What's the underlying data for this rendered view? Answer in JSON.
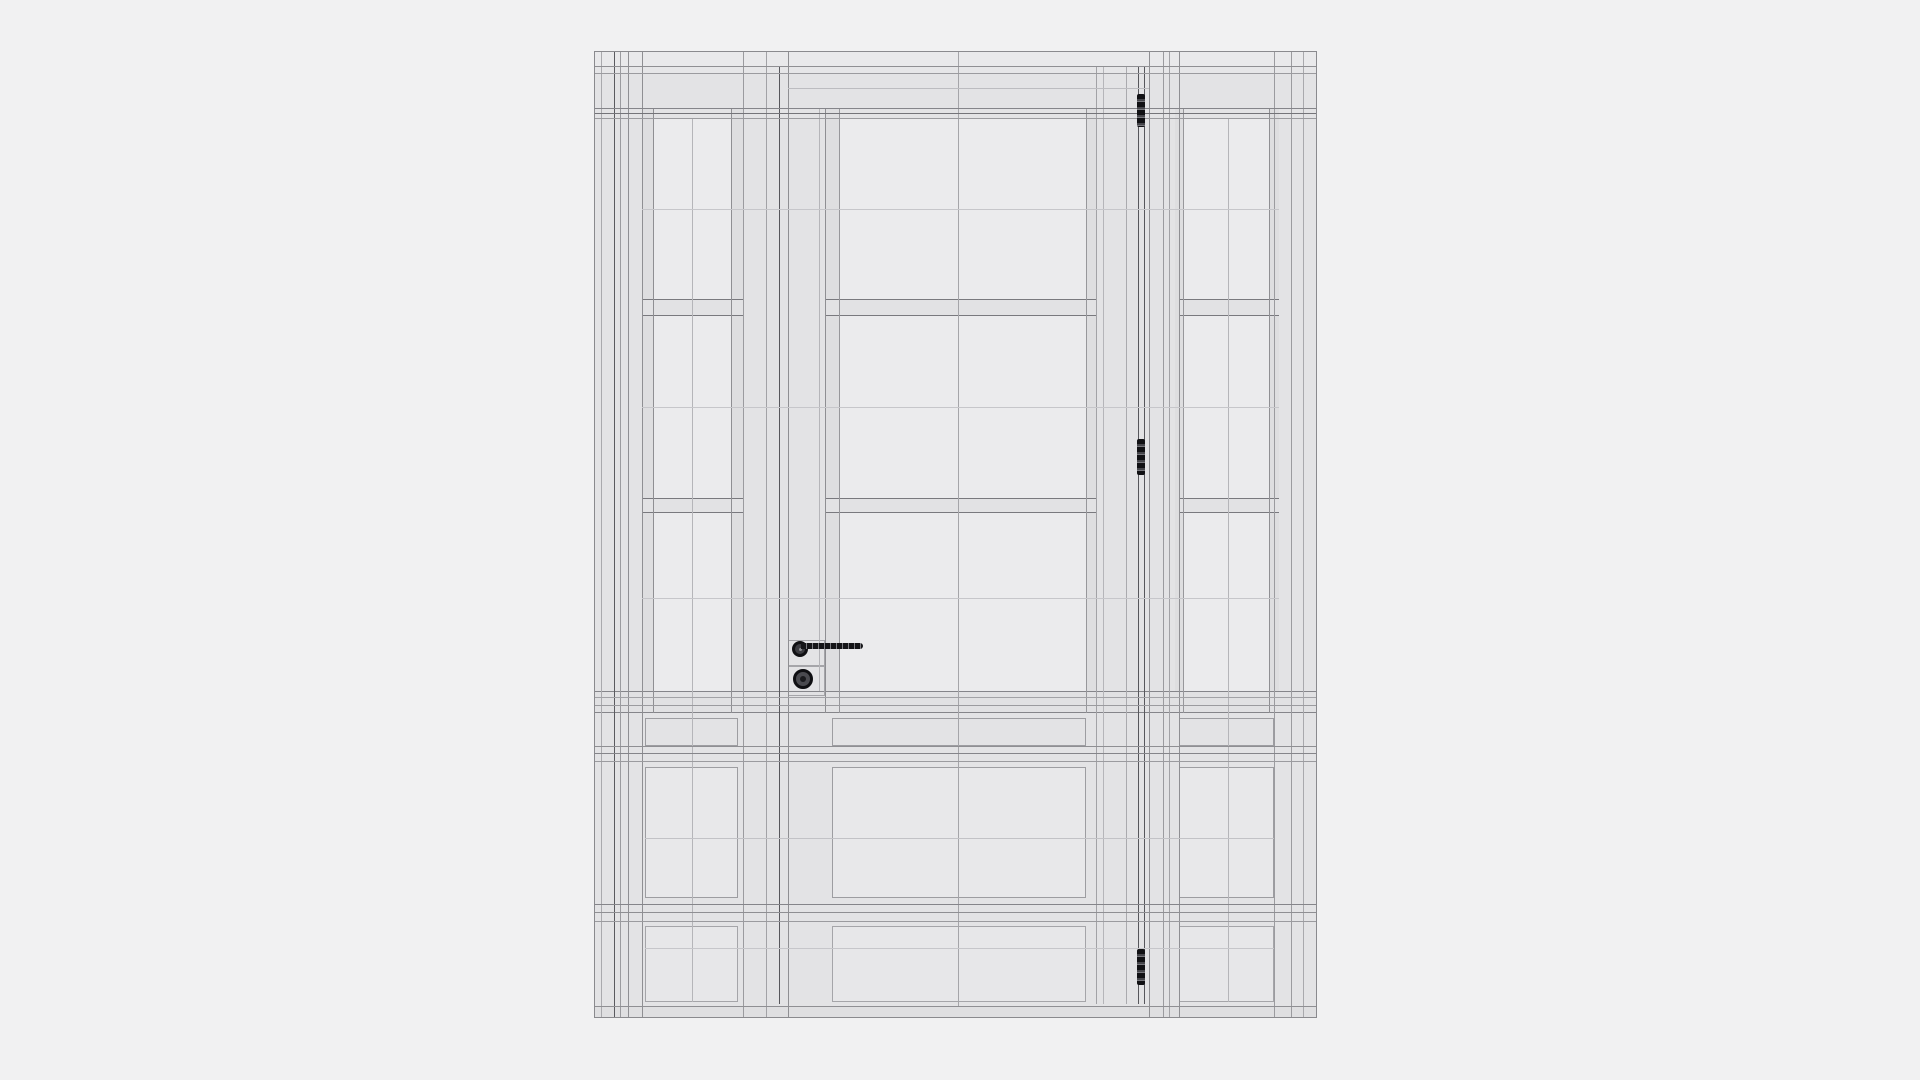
{
  "meta": {
    "description": "monochrome wireframe render of an entry door with two sidelights, three hinges, lever handle and cylinder knob",
    "background_color": "#f1f1f2",
    "unit_fill": "#e3e3e5",
    "glass_fill": "#ebebed",
    "line_dark": "#57575c",
    "line_mid": "#8f8f93",
    "line_light": "#c6c6ca",
    "hardware_color": "#151518"
  },
  "scene": {
    "unit": {
      "x": 594,
      "y": 51,
      "w": 723,
      "h": 967,
      "fill": "#e3e3e5"
    },
    "rects": [
      {
        "name": "frame-head-band",
        "x": 0,
        "y": 0,
        "w": 723,
        "h": 14,
        "fill": "#e9e9eb"
      },
      {
        "name": "frame-head-lower",
        "x": 0,
        "y": 14,
        "w": 723,
        "h": 7,
        "fill": "#e6e6e8"
      },
      {
        "name": "sidelight-left-glass",
        "x": 58,
        "y": 66,
        "w": 78,
        "h": 573,
        "fill": "#ebebed"
      },
      {
        "name": "door-glass",
        "x": 244,
        "y": 66,
        "w": 247,
        "h": 573,
        "fill": "#ebebed"
      },
      {
        "name": "sidelight-right-glass",
        "x": 588,
        "y": 66,
        "w": 86,
        "h": 573,
        "fill": "#ebebed"
      },
      {
        "name": "glass-frame-strip",
        "x": 47,
        "y": 56,
        "w": 11,
        "h": 605,
        "fill": "#dedee0"
      },
      {
        "name": "glass-frame-strip",
        "x": 136,
        "y": 56,
        "w": 12,
        "h": 605,
        "fill": "#dedee0"
      },
      {
        "name": "glass-frame-strip",
        "x": 230,
        "y": 56,
        "w": 14,
        "h": 605,
        "fill": "#dedee0"
      },
      {
        "name": "glass-frame-strip",
        "x": 491,
        "y": 56,
        "w": 10,
        "h": 605,
        "fill": "#dedee0"
      },
      {
        "name": "glass-frame-strip",
        "x": 580,
        "y": 56,
        "w": 8,
        "h": 605,
        "fill": "#dedee0"
      },
      {
        "name": "glass-frame-strip",
        "x": 674,
        "y": 56,
        "w": 10,
        "h": 605,
        "fill": "#dedee0"
      },
      {
        "name": "glazing-bar",
        "x": 47,
        "y": 247,
        "w": 101,
        "h": 17,
        "fill": "#e2e2e4",
        "bt": "#79797e",
        "bb": "#79797e"
      },
      {
        "name": "glazing-bar",
        "x": 230,
        "y": 247,
        "w": 271,
        "h": 17,
        "fill": "#e2e2e4",
        "bt": "#79797e",
        "bb": "#79797e"
      },
      {
        "name": "glazing-bar",
        "x": 584,
        "y": 247,
        "w": 100,
        "h": 17,
        "fill": "#e2e2e4",
        "bt": "#79797e",
        "bb": "#79797e"
      },
      {
        "name": "glazing-bar",
        "x": 47,
        "y": 446,
        "w": 101,
        "h": 15,
        "fill": "#e2e2e4",
        "bt": "#79797e",
        "bb": "#79797e"
      },
      {
        "name": "glazing-bar",
        "x": 230,
        "y": 446,
        "w": 271,
        "h": 15,
        "fill": "#e2e2e4",
        "bt": "#79797e",
        "bb": "#79797e"
      },
      {
        "name": "glazing-bar",
        "x": 584,
        "y": 446,
        "w": 100,
        "h": 15,
        "fill": "#e2e2e4",
        "bt": "#79797e",
        "bb": "#79797e"
      },
      {
        "name": "sill-band",
        "x": 0,
        "y": 639,
        "w": 723,
        "h": 22,
        "fill": "#e1e1e3",
        "bt": "#85858a",
        "bb": "#85858a"
      },
      {
        "name": "sub-panel",
        "x": 50,
        "y": 666,
        "w": 93,
        "h": 28,
        "border": "#9d9da1"
      },
      {
        "name": "sub-panel",
        "x": 237,
        "y": 666,
        "w": 254,
        "h": 28,
        "border": "#9d9da1"
      },
      {
        "name": "sub-panel",
        "x": 584,
        "y": 666,
        "w": 95,
        "h": 28,
        "border": "#9d9da1"
      },
      {
        "name": "mid-panel",
        "x": 50,
        "y": 715,
        "w": 93,
        "h": 131,
        "fill": "#e8e8ea",
        "border": "#9d9da1"
      },
      {
        "name": "mid-panel",
        "x": 237,
        "y": 715,
        "w": 254,
        "h": 131,
        "fill": "#e8e8ea",
        "border": "#9d9da1"
      },
      {
        "name": "mid-panel",
        "x": 584,
        "y": 715,
        "w": 95,
        "h": 131,
        "fill": "#e8e8ea",
        "border": "#9d9da1"
      },
      {
        "name": "bottom-panel",
        "x": 50,
        "y": 874,
        "w": 93,
        "h": 76,
        "fill": "#e7e7e9",
        "border": "#a5a5a9"
      },
      {
        "name": "bottom-panel",
        "x": 237,
        "y": 874,
        "w": 254,
        "h": 76,
        "fill": "#e7e7e9",
        "border": "#a5a5a9"
      },
      {
        "name": "bottom-panel",
        "x": 584,
        "y": 874,
        "w": 95,
        "h": 76,
        "fill": "#e7e7e9",
        "border": "#a5a5a9"
      },
      {
        "name": "bottom-strip",
        "x": 0,
        "y": 954,
        "w": 723,
        "h": 13,
        "fill": "#dfdfe1"
      },
      {
        "name": "lock-backplate",
        "x": 193,
        "y": 588,
        "w": 37,
        "h": 26,
        "border": "#a5a5a9"
      },
      {
        "name": "lock-backplate",
        "x": 193,
        "y": 614,
        "w": 37,
        "h": 30,
        "border": "#a5a5a9"
      }
    ],
    "vlines": [
      [
        6,
        0,
        967,
        "#a9a9ad"
      ],
      [
        19,
        0,
        967,
        "#5a5a5f"
      ],
      [
        25,
        0,
        967,
        "#9b9b9f"
      ],
      [
        33,
        0,
        967,
        "#8f8f93"
      ],
      [
        47,
        0,
        967,
        "#8f8f93"
      ],
      [
        58,
        56,
        661,
        "#8f8f93"
      ],
      [
        97,
        66,
        950,
        "#b5b5b9"
      ],
      [
        136,
        56,
        661,
        "#8f8f93"
      ],
      [
        148,
        0,
        967,
        "#9b9b9f"
      ],
      [
        171,
        0,
        967,
        "#a2a2a6"
      ],
      [
        184,
        14,
        952,
        "#57575c"
      ],
      [
        193,
        0,
        967,
        "#8f8f93"
      ],
      [
        224,
        56,
        639,
        "#b5b5b9"
      ],
      [
        230,
        56,
        661,
        "#8f8f93"
      ],
      [
        244,
        56,
        661,
        "#97979b"
      ],
      [
        363,
        0,
        954,
        "#a5a5a9"
      ],
      [
        491,
        56,
        661,
        "#97979b"
      ],
      [
        501,
        14,
        952,
        "#a2a2a6"
      ],
      [
        508,
        14,
        952,
        "#b5b5b9"
      ],
      [
        531,
        14,
        952,
        "#aaaaae"
      ],
      [
        543,
        14,
        952,
        "#57575c"
      ],
      [
        549,
        14,
        952,
        "#57575c"
      ],
      [
        554,
        0,
        967,
        "#8f8f93"
      ],
      [
        568,
        0,
        967,
        "#9b9b9f"
      ],
      [
        574,
        0,
        967,
        "#a2a2a6"
      ],
      [
        584,
        0,
        967,
        "#8f8f93"
      ],
      [
        588,
        56,
        661,
        "#97979b"
      ],
      [
        633,
        66,
        950,
        "#b5b5b9"
      ],
      [
        674,
        56,
        661,
        "#8f8f93"
      ],
      [
        679,
        0,
        967,
        "#9b9b9f"
      ],
      [
        696,
        0,
        967,
        "#9b9b9f"
      ],
      [
        708,
        0,
        967,
        "#a9a9ad"
      ]
    ],
    "hlines": [
      [
        14,
        0,
        723,
        "#8f8f93"
      ],
      [
        21,
        0,
        723,
        "#9b9b9f"
      ],
      [
        36,
        193,
        554,
        "#bcbcc0"
      ],
      [
        56,
        0,
        723,
        "#85858a"
      ],
      [
        61,
        0,
        723,
        "#747479"
      ],
      [
        66,
        0,
        723,
        "#9b9b9f"
      ],
      [
        157,
        47,
        684,
        "#c6c6ca"
      ],
      [
        355,
        47,
        684,
        "#c6c6ca"
      ],
      [
        546,
        47,
        684,
        "#c6c6ca"
      ],
      [
        645,
        0,
        723,
        "#a2a2a6"
      ],
      [
        653,
        0,
        723,
        "#9b9b9f"
      ],
      [
        694,
        0,
        723,
        "#8f8f93"
      ],
      [
        701,
        0,
        723,
        "#85858a"
      ],
      [
        709,
        0,
        723,
        "#9b9b9f"
      ],
      [
        786,
        50,
        679,
        "#c2c2c6"
      ],
      [
        852,
        0,
        723,
        "#85858a"
      ],
      [
        860,
        0,
        723,
        "#8f8f93"
      ],
      [
        869,
        0,
        723,
        "#9b9b9f"
      ],
      [
        896,
        50,
        679,
        "#c6c6ca"
      ],
      [
        954,
        0,
        723,
        "#8f8f93"
      ]
    ],
    "hinges": [
      {
        "name": "hinge-top",
        "x": 542,
        "y": 42,
        "w": 8,
        "h": 33
      },
      {
        "name": "hinge-middle",
        "x": 542,
        "y": 387,
        "w": 8,
        "h": 36
      },
      {
        "name": "hinge-bottom",
        "x": 542,
        "y": 897,
        "w": 8,
        "h": 36
      }
    ],
    "hinge_colors": {
      "body": "#111114",
      "knuckle": "#45454a",
      "gap": "#77777c"
    },
    "handle": {
      "rose": {
        "cx": 205,
        "cy": 597,
        "r": 8,
        "ring": "#101013",
        "fill": "#3c3c41",
        "dot": "#8a8a8e"
      },
      "lever": {
        "x": 206,
        "y": 591,
        "w": 62,
        "h": 6,
        "fill": "#151518",
        "dash": "#7d7d82"
      },
      "knob": {
        "cx": 208,
        "cy": 627,
        "r": 10,
        "ring": "#0f0f12",
        "fill": "#4a4a4f",
        "core": "#1a1a1d"
      }
    }
  }
}
